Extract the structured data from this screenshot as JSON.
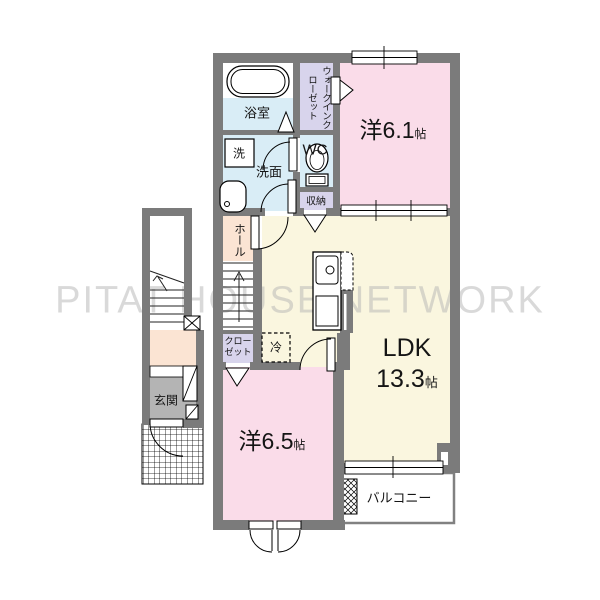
{
  "watermark": "PITAT HOUSE NETWORK",
  "rooms": {
    "bath": {
      "label": "浴室"
    },
    "washer": {
      "label": "洗"
    },
    "vanity": {
      "label": "洗面"
    },
    "wc": {
      "label": "WC"
    },
    "walk_in_closet": {
      "label": "ウォークインクローゼット"
    },
    "storage": {
      "label": "収納"
    },
    "hall": {
      "label": "ホール"
    },
    "bedroom1": {
      "label": "洋6.1",
      "unit": "帖"
    },
    "ldk": {
      "label": "LDK",
      "area": "13.3",
      "unit": "帖"
    },
    "closet": {
      "label": "クローゼット"
    },
    "refrigerator": {
      "label": "冷"
    },
    "entrance": {
      "label": "玄関"
    },
    "bedroom2": {
      "label": "洋6.5",
      "unit": "帖"
    },
    "balcony": {
      "label": "バルコニー"
    }
  },
  "colors": {
    "wall": "#7b7b7b",
    "room_pink": "#fadce9",
    "room_cream": "#faf6df",
    "room_peach": "#fbe4d3",
    "room_blue": "#d9edf6",
    "room_lavender": "#d8d4ec",
    "entrance_gray": "#b4b4b4",
    "watermark_gray": "#b5b5b5"
  }
}
